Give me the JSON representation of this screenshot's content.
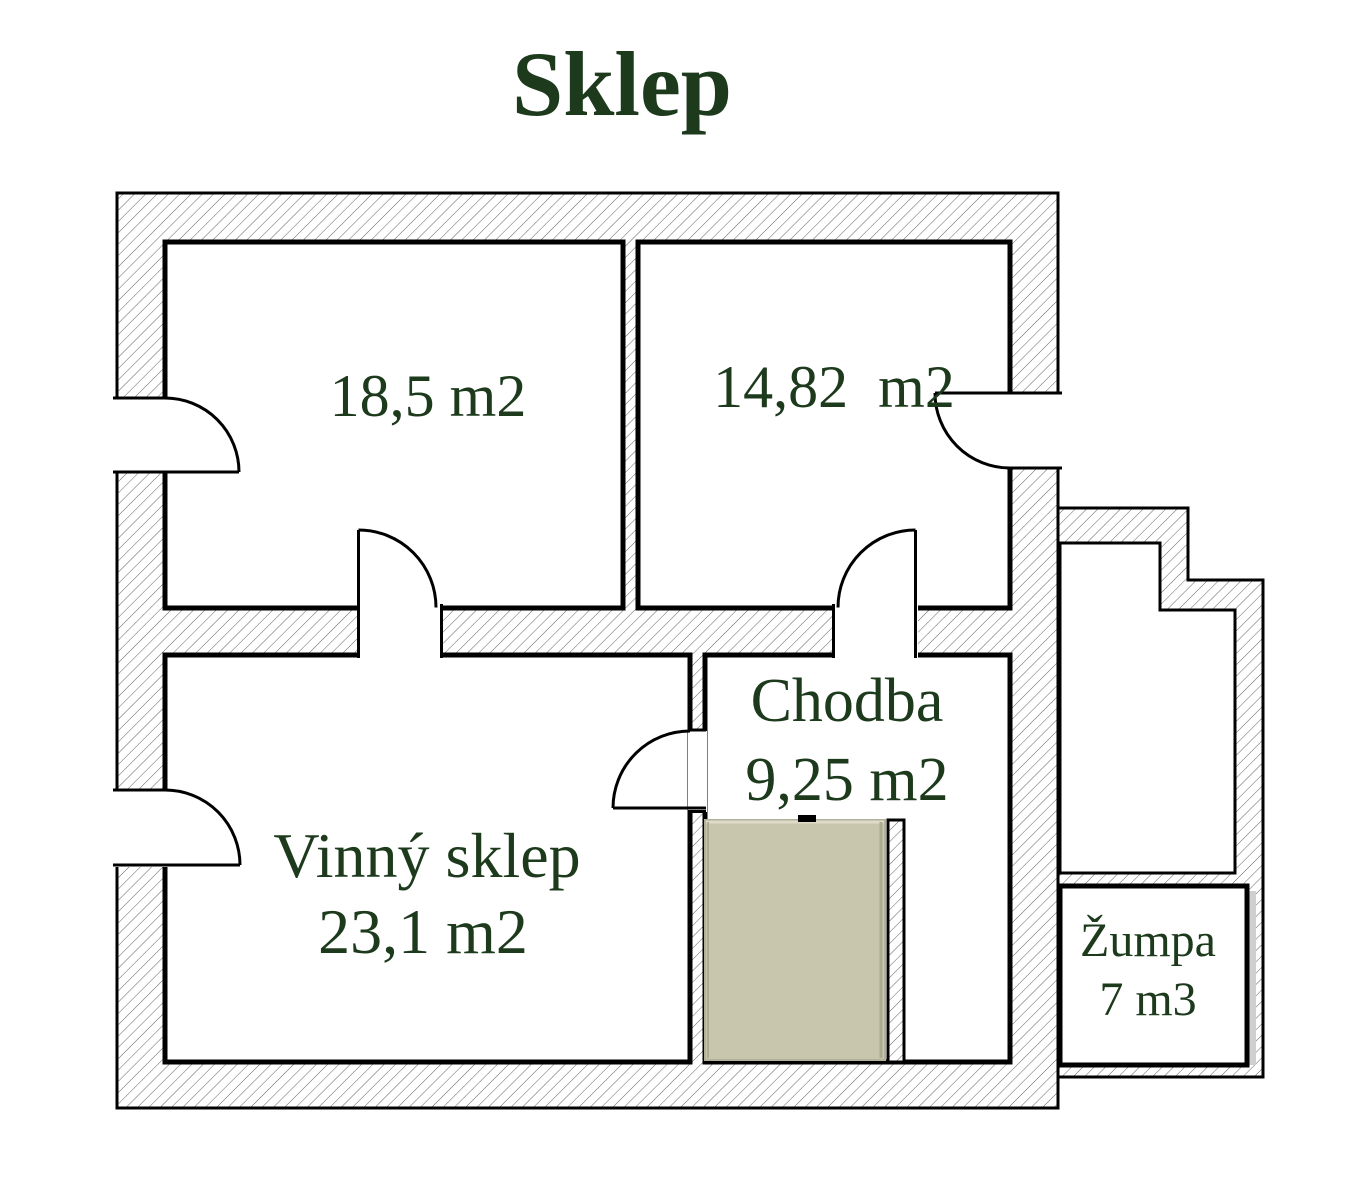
{
  "title": "Sklep",
  "rooms": [
    {
      "label": "18,5 m2"
    },
    {
      "label": "14,82  m2"
    },
    {
      "name": "Vinný sklep",
      "area": "23,1 m2"
    },
    {
      "name": "Chodba",
      "area": "9,25 m2"
    },
    {
      "name": "Žumpa",
      "volume": "7 m3"
    }
  ],
  "colors": {
    "label_text": "#1d3a1d",
    "wall_line": "#000000",
    "hatch_line": "#636363",
    "stairs_fill": "#c9c6ae",
    "background": "#ffffff"
  }
}
